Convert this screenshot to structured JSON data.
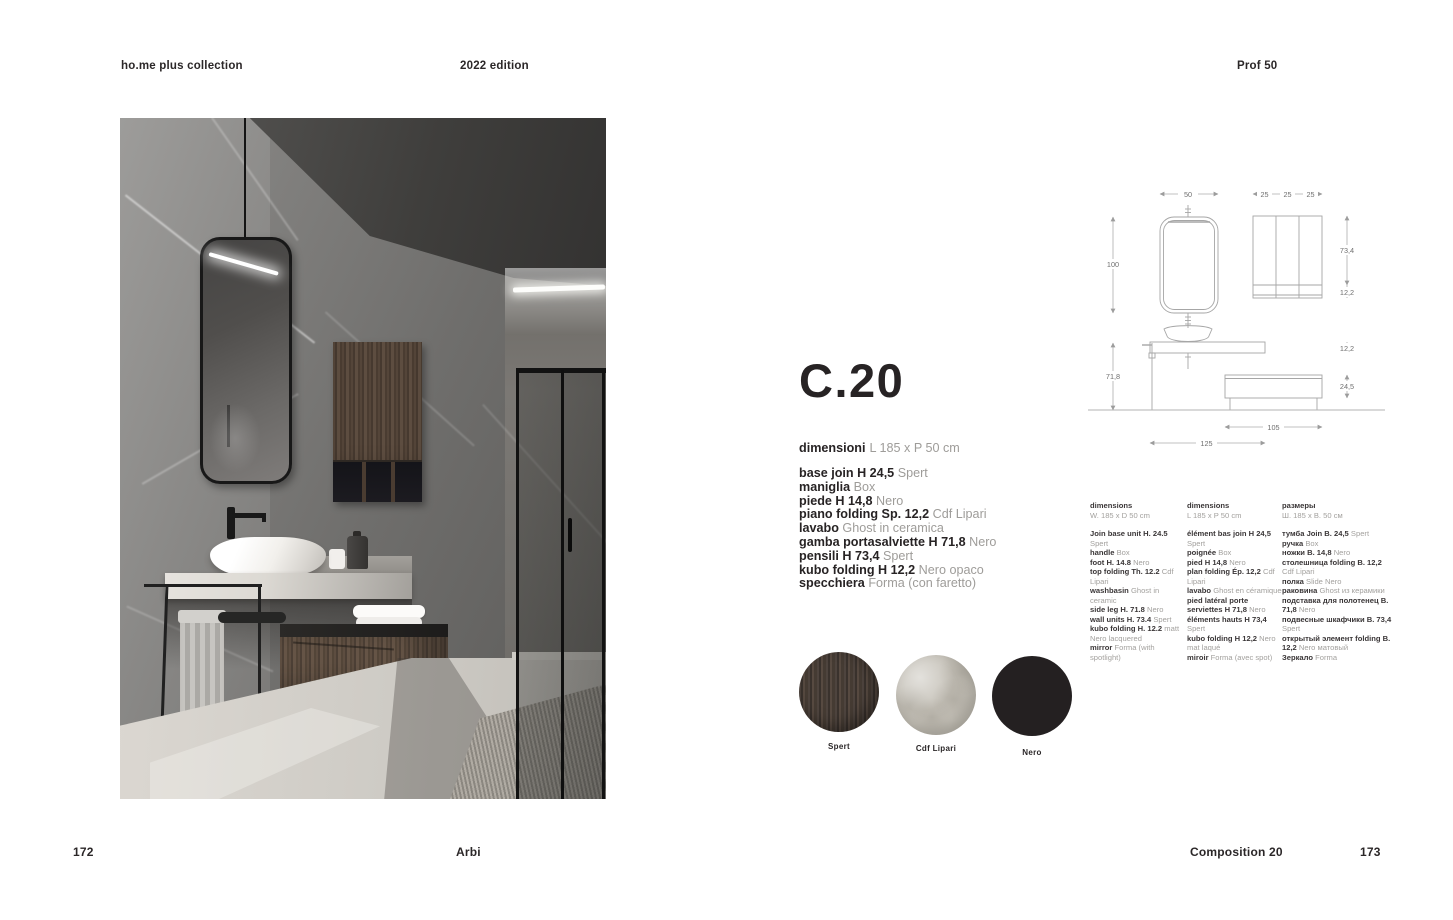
{
  "header": {
    "collection": "ho.me plus collection",
    "edition": "2022 edition",
    "profile": "Prof 50"
  },
  "product": {
    "code": "C.20",
    "dimensions_label": "dimensioni",
    "dimensions_value": "L 185 x P 50 cm",
    "specs": [
      {
        "label": "base join H 24,5",
        "value": "Spert"
      },
      {
        "label": "maniglia",
        "value": "Box"
      },
      {
        "label": "piede H 14,8",
        "value": "Nero"
      },
      {
        "label": "piano folding Sp. 12,2",
        "value": "Cdf Lipari"
      },
      {
        "label": "lavabo",
        "value": "Ghost in ceramica"
      },
      {
        "label": "gamba portasalviette H 71,8",
        "value": "Nero"
      },
      {
        "label": "pensili H 73,4",
        "value": "Spert"
      },
      {
        "label": "kubo folding H 12,2",
        "value": "Nero opaco"
      },
      {
        "label": "specchiera",
        "value": "Forma (con faretto)"
      }
    ]
  },
  "columns": {
    "en": {
      "header": "dimensions",
      "size": "W. 185 x D 50 cm",
      "items": [
        {
          "label": "Join base unit H. 24.5",
          "value": "Spert"
        },
        {
          "label": "handle",
          "value": "Box"
        },
        {
          "label": "foot H. 14.8",
          "value": "Nero"
        },
        {
          "label": "top folding Th. 12.2",
          "value": "Cdf Lipari"
        },
        {
          "label": "washbasin",
          "value": "Ghost in ceramic"
        },
        {
          "label": "side leg H. 71.8",
          "value": "Nero"
        },
        {
          "label": "wall units H. 73.4",
          "value": "Spert"
        },
        {
          "label": "kubo folding H. 12.2",
          "value": "matt Nero lacquered"
        },
        {
          "label": "mirror",
          "value": "Forma (with spotlight)"
        }
      ]
    },
    "fr": {
      "header": "dimensions",
      "size": "L 185 x P 50 cm",
      "items": [
        {
          "label": "élément bas join H 24,5",
          "value": "Spert"
        },
        {
          "label": "poignée",
          "value": "Box"
        },
        {
          "label": "pied H 14,8",
          "value": "Nero"
        },
        {
          "label": "plan folding Ép. 12,2",
          "value": "Cdf Lipari"
        },
        {
          "label": "lavabo",
          "value": "Ghost en céramique"
        },
        {
          "label": "pied latéral porte serviettes H 71,8",
          "value": "Nero"
        },
        {
          "label": "éléments hauts H 73,4",
          "value": "Spert"
        },
        {
          "label": "kubo folding H 12,2",
          "value": "Nero mat laqué"
        },
        {
          "label": "miroir",
          "value": "Forma (avec spot)"
        }
      ]
    },
    "ru": {
      "header": "размеры",
      "size": "Ш. 185 х В. 50 см",
      "items": [
        {
          "label": "тумба Join В. 24,5",
          "value": "Spert"
        },
        {
          "label": "ручка",
          "value": "Box"
        },
        {
          "label": "ножки В. 14,8",
          "value": "Nero"
        },
        {
          "label": "столешница folding В. 12,2",
          "value": "Cdf Lipari"
        },
        {
          "label": "полка",
          "value": "Slide Nero"
        },
        {
          "label": "раковина",
          "value": "Ghost из керамики"
        },
        {
          "label": "подставка для полотенец В. 71,8",
          "value": "Nero"
        },
        {
          "label": "подвесные шкафчики В. 73,4",
          "value": "Spert"
        },
        {
          "label": "открытый элемент folding В. 12,2",
          "value": "Nero матовый"
        },
        {
          "label": "Зеркало",
          "value": "Forma"
        }
      ]
    }
  },
  "swatches": [
    {
      "name": "Spert",
      "color": "#463d37"
    },
    {
      "name": "Cdf Lipari",
      "color": "#c6c2b9"
    },
    {
      "name": "Nero",
      "color": "#232021"
    }
  ],
  "drawing": {
    "d50": "50",
    "d25a": "25",
    "d25b": "25",
    "d25c": "25",
    "d100": "100",
    "d71_8": "71,8",
    "d73_4": "73,4",
    "d12_2a": "12,2",
    "d12_2b": "12,2",
    "d24_5": "24,5",
    "d105": "105",
    "d125": "125"
  },
  "footer": {
    "page_left": "172",
    "brand": "Arbi",
    "composition": "Composition 20",
    "page_right": "173"
  }
}
